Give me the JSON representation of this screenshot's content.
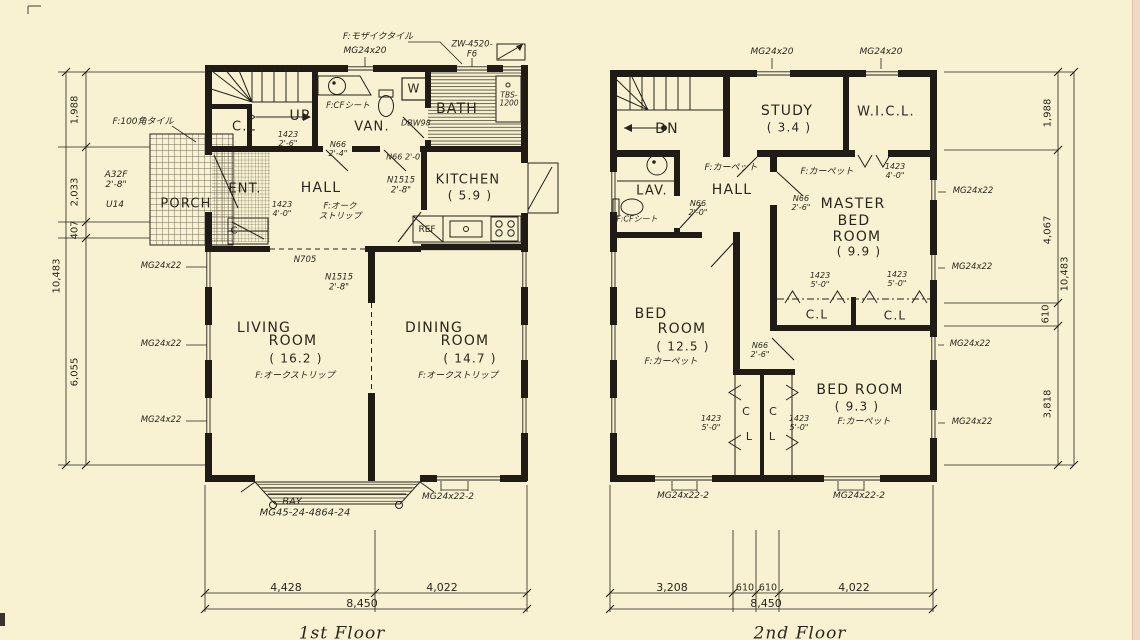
{
  "canvas": {
    "background": "#f8f2d3",
    "ink": "#26221b",
    "wall": "#201b14",
    "artifact_pink": "#f2d9c6"
  },
  "floor1": {
    "title_label": "1st Floor",
    "labels": [
      {
        "t": "F:モザイクタイル",
        "x": 378,
        "y": 37,
        "fs": 9,
        "it": 1
      },
      {
        "t": "MG24x20",
        "x": 365,
        "y": 51,
        "fs": 9,
        "it": 1
      },
      {
        "t": "ZW-4520-\nF6",
        "x": 472,
        "y": 50,
        "fs": 8.5,
        "it": 1
      },
      {
        "t": "C.L",
        "x": 244,
        "y": 128,
        "fs": 13
      },
      {
        "t": "UP",
        "x": 300,
        "y": 117,
        "fs": 14
      },
      {
        "t": "1423\n2'-6\"",
        "x": 288,
        "y": 140,
        "fs": 8,
        "it": 1
      },
      {
        "t": "F:CFシート",
        "x": 348,
        "y": 107,
        "fs": 8.5,
        "it": 1
      },
      {
        "t": "VAN.",
        "x": 372,
        "y": 128,
        "fs": 13
      },
      {
        "t": "W",
        "x": 414,
        "y": 89,
        "fs": 12
      },
      {
        "t": "BATH",
        "x": 457,
        "y": 110,
        "fs": 14
      },
      {
        "t": "TBS-\n1200",
        "x": 509,
        "y": 100,
        "fs": 7.5,
        "it": 1
      },
      {
        "t": "DBW98",
        "x": 416,
        "y": 124,
        "fs": 8,
        "it": 1
      },
      {
        "t": "N66\n2'-4\"",
        "x": 338,
        "y": 150,
        "fs": 8,
        "it": 1
      },
      {
        "t": "N66 2'-0\"",
        "x": 405,
        "y": 158,
        "fs": 8,
        "it": 1
      },
      {
        "t": "N1515\n2'-8\"",
        "x": 401,
        "y": 186,
        "fs": 8.5,
        "it": 1
      },
      {
        "t": "KITCHEN",
        "x": 468,
        "y": 181,
        "fs": 13
      },
      {
        "t": "( 5.9 )",
        "x": 470,
        "y": 196,
        "fs": 12
      },
      {
        "t": "REF",
        "x": 427,
        "y": 230,
        "fs": 9
      },
      {
        "t": "F:100角タイル",
        "x": 143,
        "y": 122,
        "fs": 9,
        "it": 1
      },
      {
        "t": "A32F\n2'-8\"",
        "x": 116,
        "y": 180,
        "fs": 9,
        "it": 1
      },
      {
        "t": "U14",
        "x": 115,
        "y": 205,
        "fs": 9,
        "it": 1
      },
      {
        "t": "PORCH",
        "x": 186,
        "y": 205,
        "fs": 13
      },
      {
        "t": "ENT.",
        "x": 245,
        "y": 190,
        "fs": 13
      },
      {
        "t": "HALL",
        "x": 321,
        "y": 189,
        "fs": 14
      },
      {
        "t": "C",
        "x": 234,
        "y": 231,
        "fs": 10
      },
      {
        "t": "1423\n4'-0\"",
        "x": 282,
        "y": 210,
        "fs": 8,
        "it": 1
      },
      {
        "t": "F:オーク\nストリップ",
        "x": 340,
        "y": 212,
        "fs": 8.5,
        "it": 1
      },
      {
        "t": "N705",
        "x": 305,
        "y": 261,
        "fs": 8.5,
        "it": 1
      },
      {
        "t": "N1515\n2'-8\"",
        "x": 339,
        "y": 283,
        "fs": 8.5,
        "it": 1
      },
      {
        "t": "MG24x22",
        "x": 161,
        "y": 267,
        "fs": 8.5,
        "it": 1
      },
      {
        "t": "MG24x22",
        "x": 161,
        "y": 345,
        "fs": 8.5,
        "it": 1
      },
      {
        "t": "MG24x22",
        "x": 161,
        "y": 421,
        "fs": 8.5,
        "it": 1
      },
      {
        "t": "LIVING",
        "x": 264,
        "y": 329,
        "fs": 14
      },
      {
        "t": "ROOM",
        "x": 293,
        "y": 342,
        "fs": 14
      },
      {
        "t": "( 16.2 )",
        "x": 296,
        "y": 359,
        "fs": 12
      },
      {
        "t": "F:オークストリップ",
        "x": 295,
        "y": 376,
        "fs": 9,
        "it": 1
      },
      {
        "t": "DINING",
        "x": 434,
        "y": 329,
        "fs": 14
      },
      {
        "t": "ROOM",
        "x": 465,
        "y": 342,
        "fs": 14
      },
      {
        "t": "( 14.7 )",
        "x": 470,
        "y": 359,
        "fs": 12
      },
      {
        "t": "F:オークストリップ",
        "x": 458,
        "y": 376,
        "fs": 9,
        "it": 1
      },
      {
        "t": "BAY",
        "x": 292,
        "y": 502,
        "fs": 10,
        "it": 1
      },
      {
        "t": "MG45-24-4864-24",
        "x": 305,
        "y": 513,
        "fs": 10,
        "it": 1
      },
      {
        "t": "MG24x22-2",
        "x": 448,
        "y": 497,
        "fs": 9,
        "it": 1
      },
      {
        "t": "4,428",
        "x": 286,
        "y": 588,
        "fs": 11
      },
      {
        "t": "4,022",
        "x": 442,
        "y": 588,
        "fs": 11
      },
      {
        "t": "8,450",
        "x": 362,
        "y": 604,
        "fs": 11
      },
      {
        "t": "1,988",
        "x": 75,
        "y": 110,
        "fs": 10,
        "rot": -90
      },
      {
        "t": "2,033",
        "x": 75,
        "y": 192,
        "fs": 10,
        "rot": -90
      },
      {
        "t": "407",
        "x": 75,
        "y": 230,
        "fs": 10,
        "rot": -90
      },
      {
        "t": "6,055",
        "x": 75,
        "y": 372,
        "fs": 10,
        "rot": -90
      },
      {
        "t": "10,483",
        "x": 57,
        "y": 276,
        "fs": 10,
        "rot": -90
      },
      {
        "t": "1st Floor",
        "x": 342,
        "y": 634,
        "fs": 17,
        "cls": "title"
      }
    ]
  },
  "floor2": {
    "title_label": "2nd Floor",
    "labels": [
      {
        "t": "MG24x20",
        "x": 772,
        "y": 52,
        "fs": 9,
        "it": 1
      },
      {
        "t": "MG24x20",
        "x": 881,
        "y": 52,
        "fs": 9,
        "it": 1
      },
      {
        "t": "DN",
        "x": 667,
        "y": 130,
        "fs": 14
      },
      {
        "t": "STUDY",
        "x": 787,
        "y": 112,
        "fs": 14
      },
      {
        "t": "( 3.4 )",
        "x": 789,
        "y": 128,
        "fs": 12
      },
      {
        "t": "W.I.C.L.",
        "x": 886,
        "y": 113,
        "fs": 13
      },
      {
        "t": "LAV.",
        "x": 652,
        "y": 192,
        "fs": 13
      },
      {
        "t": "F:CFシート",
        "x": 637,
        "y": 220,
        "fs": 8,
        "it": 1
      },
      {
        "t": "F:カーペット",
        "x": 731,
        "y": 168,
        "fs": 9,
        "it": 1
      },
      {
        "t": "HALL",
        "x": 732,
        "y": 191,
        "fs": 14
      },
      {
        "t": "N66\n2'-0\"",
        "x": 698,
        "y": 209,
        "fs": 8,
        "it": 1
      },
      {
        "t": "F:カーペット",
        "x": 827,
        "y": 172,
        "fs": 9,
        "it": 1
      },
      {
        "t": "N66\n2'-6\"",
        "x": 801,
        "y": 204,
        "fs": 8,
        "it": 1
      },
      {
        "t": "1423\n4'-0\"",
        "x": 895,
        "y": 172,
        "fs": 8,
        "it": 1
      },
      {
        "t": "MASTER",
        "x": 853,
        "y": 205,
        "fs": 14
      },
      {
        "t": "BED",
        "x": 854,
        "y": 222,
        "fs": 14
      },
      {
        "t": "ROOM",
        "x": 857,
        "y": 238,
        "fs": 14
      },
      {
        "t": "( 9.9 )",
        "x": 859,
        "y": 252,
        "fs": 12
      },
      {
        "t": "1423\n5'-0\"",
        "x": 820,
        "y": 281,
        "fs": 8,
        "it": 1
      },
      {
        "t": "1423\n5'-0\"",
        "x": 897,
        "y": 280,
        "fs": 8,
        "it": 1
      },
      {
        "t": "C.L",
        "x": 817,
        "y": 315,
        "fs": 12
      },
      {
        "t": "C.L",
        "x": 895,
        "y": 316,
        "fs": 12
      },
      {
        "t": "MG24x22",
        "x": 973,
        "y": 192,
        "fs": 8.5,
        "it": 1
      },
      {
        "t": "MG24x22",
        "x": 972,
        "y": 268,
        "fs": 8.5,
        "it": 1
      },
      {
        "t": "MG24x22",
        "x": 970,
        "y": 345,
        "fs": 8.5,
        "it": 1
      },
      {
        "t": "MG24x22",
        "x": 972,
        "y": 423,
        "fs": 8.5,
        "it": 1
      },
      {
        "t": "BED",
        "x": 651,
        "y": 315,
        "fs": 14
      },
      {
        "t": "ROOM",
        "x": 682,
        "y": 330,
        "fs": 14
      },
      {
        "t": "( 12.5 )",
        "x": 683,
        "y": 347,
        "fs": 12
      },
      {
        "t": "F:カーペット",
        "x": 671,
        "y": 362,
        "fs": 9,
        "it": 1
      },
      {
        "t": "N66\n2'-6\"",
        "x": 760,
        "y": 351,
        "fs": 8,
        "it": 1
      },
      {
        "t": "1423\n5'-0\"",
        "x": 711,
        "y": 424,
        "fs": 8,
        "it": 1
      },
      {
        "t": "1423\n5'-0\"",
        "x": 799,
        "y": 424,
        "fs": 8,
        "it": 1
      },
      {
        "t": "C",
        "x": 746,
        "y": 412,
        "fs": 11
      },
      {
        "t": "C",
        "x": 773,
        "y": 412,
        "fs": 11
      },
      {
        "t": "L",
        "x": 749,
        "y": 437,
        "fs": 11
      },
      {
        "t": "L",
        "x": 772,
        "y": 437,
        "fs": 11
      },
      {
        "t": "BED ROOM",
        "x": 860,
        "y": 391,
        "fs": 14
      },
      {
        "t": "( 9.3 )",
        "x": 857,
        "y": 407,
        "fs": 12
      },
      {
        "t": "F:カーペット",
        "x": 864,
        "y": 422,
        "fs": 9,
        "it": 1
      },
      {
        "t": "MG24x22-2",
        "x": 683,
        "y": 496,
        "fs": 9,
        "it": 1
      },
      {
        "t": "MG24x22-2",
        "x": 859,
        "y": 496,
        "fs": 9,
        "it": 1
      },
      {
        "t": "3,208",
        "x": 672,
        "y": 588,
        "fs": 11
      },
      {
        "t": "610",
        "x": 745,
        "y": 589,
        "fs": 9.5
      },
      {
        "t": "610",
        "x": 768,
        "y": 589,
        "fs": 9.5
      },
      {
        "t": "4,022",
        "x": 854,
        "y": 588,
        "fs": 11
      },
      {
        "t": "8,450",
        "x": 766,
        "y": 604,
        "fs": 11
      },
      {
        "t": "1,988",
        "x": 1048,
        "y": 113,
        "fs": 10,
        "rot": -90
      },
      {
        "t": "4,067",
        "x": 1048,
        "y": 230,
        "fs": 10,
        "rot": -90
      },
      {
        "t": "610",
        "x": 1046,
        "y": 314,
        "fs": 10,
        "rot": -90
      },
      {
        "t": "3,818",
        "x": 1048,
        "y": 404,
        "fs": 10,
        "rot": -90
      },
      {
        "t": "10,483",
        "x": 1065,
        "y": 274,
        "fs": 10,
        "rot": -90
      },
      {
        "t": "2nd Floor",
        "x": 800,
        "y": 634,
        "fs": 17,
        "cls": "title"
      }
    ]
  }
}
